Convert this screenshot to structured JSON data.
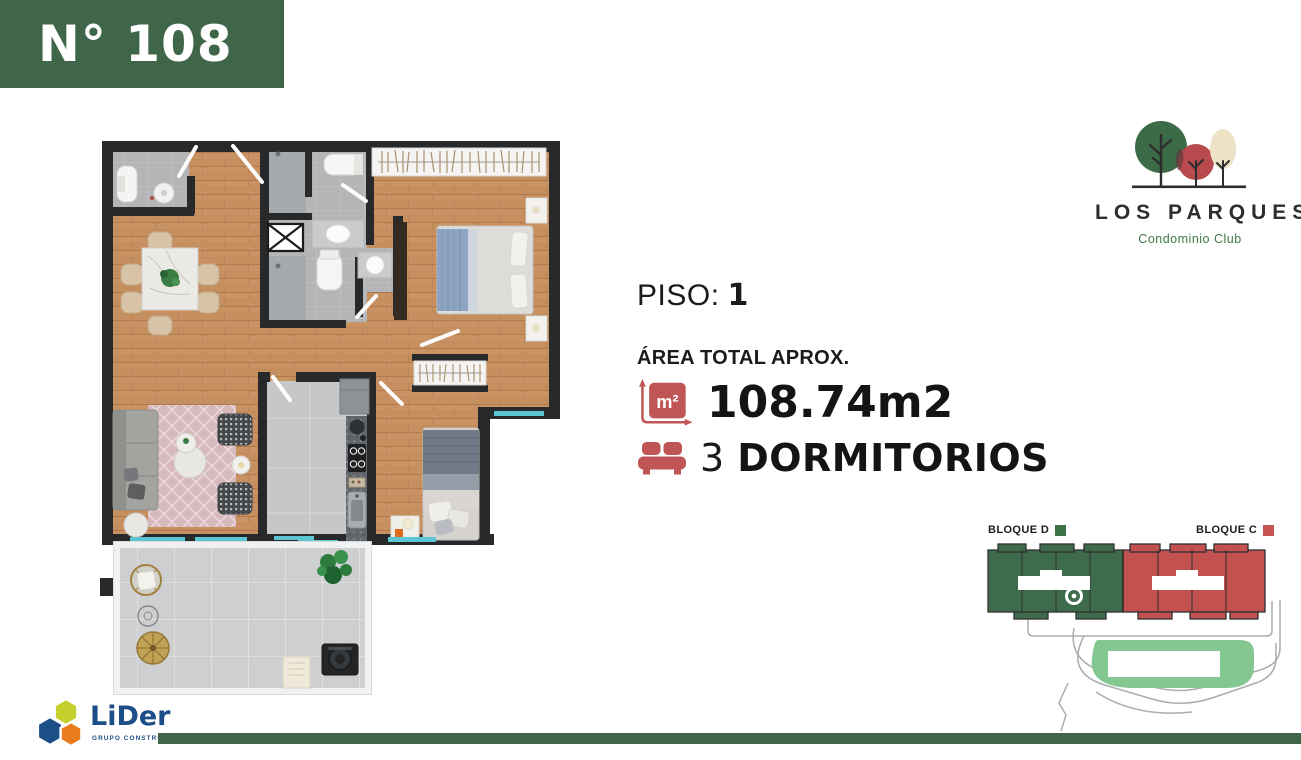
{
  "banner": {
    "unit_number": "N° 108"
  },
  "brand": {
    "name": "LOS PARQUES",
    "subtitle": "Condominio Club"
  },
  "info": {
    "floor_label": "PISO:",
    "floor_value": "1",
    "area_label": "ÁREA TOTAL APROX.",
    "area_icon_text": "m²",
    "area_value": "108.74m2",
    "bedrooms_count": "3",
    "bedrooms_label": "DORMITORIOS"
  },
  "site_plan": {
    "block_d_label": "BLOQUE D",
    "block_c_label": "BLOQUE C",
    "block_d_color": "#3d6b4c",
    "block_c_color": "#c25150",
    "park_color": "#84c791"
  },
  "footer": {
    "company_name": "LiDer",
    "company_subtitle": "GRUPO CONSTRUCTOR"
  },
  "colors": {
    "brand_green": "#40664a",
    "accent_red": "#c05556",
    "window_teal": "#5bc6d1"
  }
}
